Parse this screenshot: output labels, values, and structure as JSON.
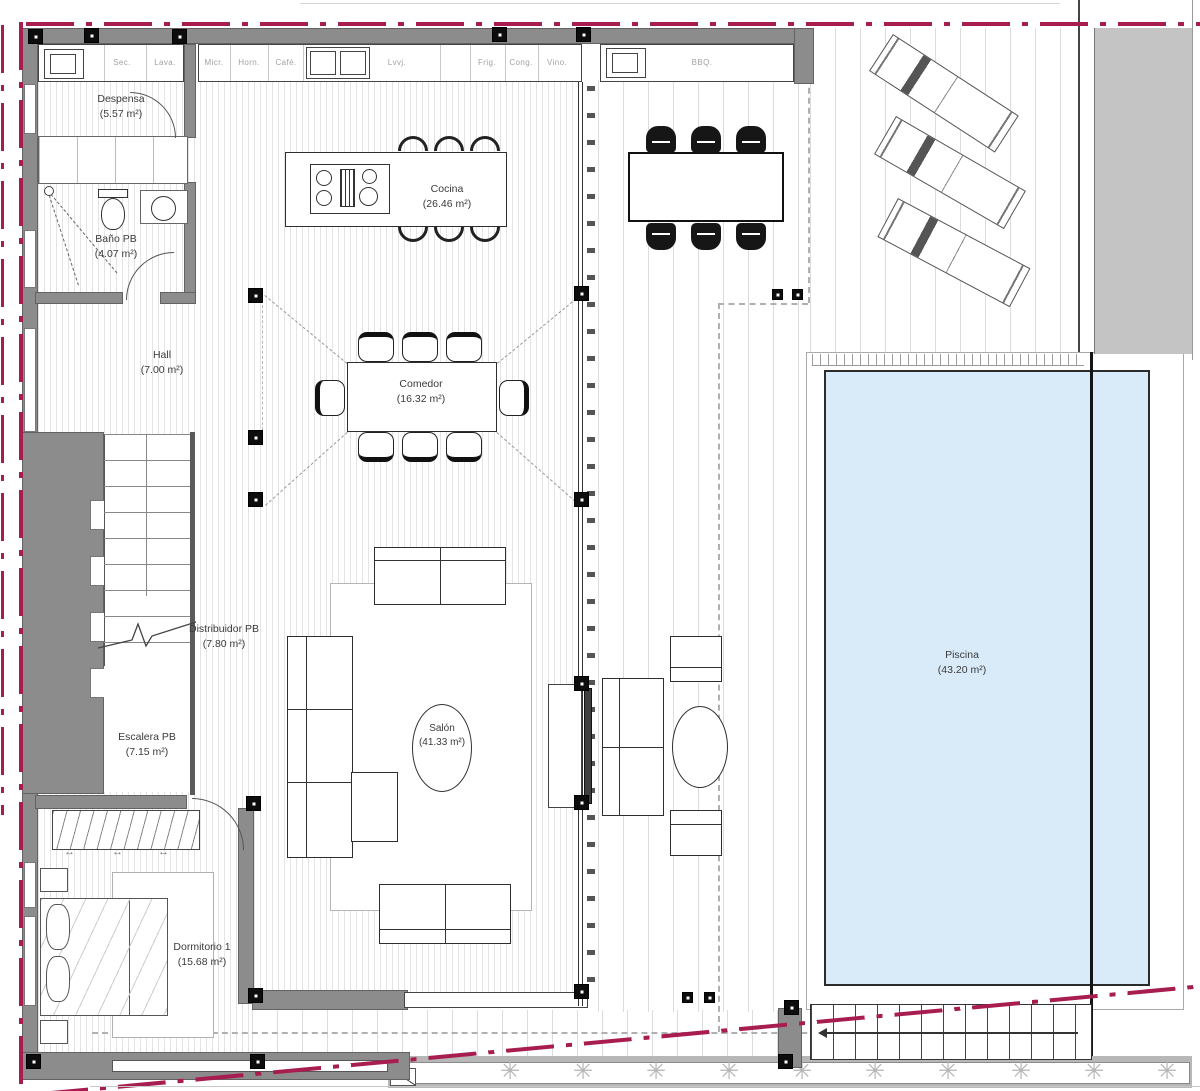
{
  "rooms": [
    {
      "name": "Despensa",
      "area": "(5.57 m²)"
    },
    {
      "name": "Baño PB",
      "area": "(4.07 m²)"
    },
    {
      "name": "Hall",
      "area": "(7.00 m²)"
    },
    {
      "name": "Cocina",
      "area": "(26.46 m²)"
    },
    {
      "name": "Comedor",
      "area": "(16.32 m²)"
    },
    {
      "name": "Salón",
      "area": "(41.33 m²)"
    },
    {
      "name": "Distribuidor PB",
      "area": "(7.80 m²)"
    },
    {
      "name": "Escalera PB",
      "area": "(7.15 m²)"
    },
    {
      "name": "Dormitorio 1",
      "area": "(15.68 m²)"
    },
    {
      "name": "Piscina",
      "area": "(43.20 m²)"
    }
  ],
  "appliances": [
    "Sec.",
    "Lava.",
    "Micr.",
    "Horn.",
    "Café.",
    "Lvvj.",
    "Frig.",
    "Cong.",
    "Vino.",
    "BBQ."
  ],
  "glyphs": {
    "plant": "✳",
    "double_arrow": "↔"
  },
  "colors": {
    "boundary": "#a81d4f",
    "wall": "#8c8c8c",
    "pool_water": "#d9eaf8",
    "band": "#c4c4c4"
  }
}
